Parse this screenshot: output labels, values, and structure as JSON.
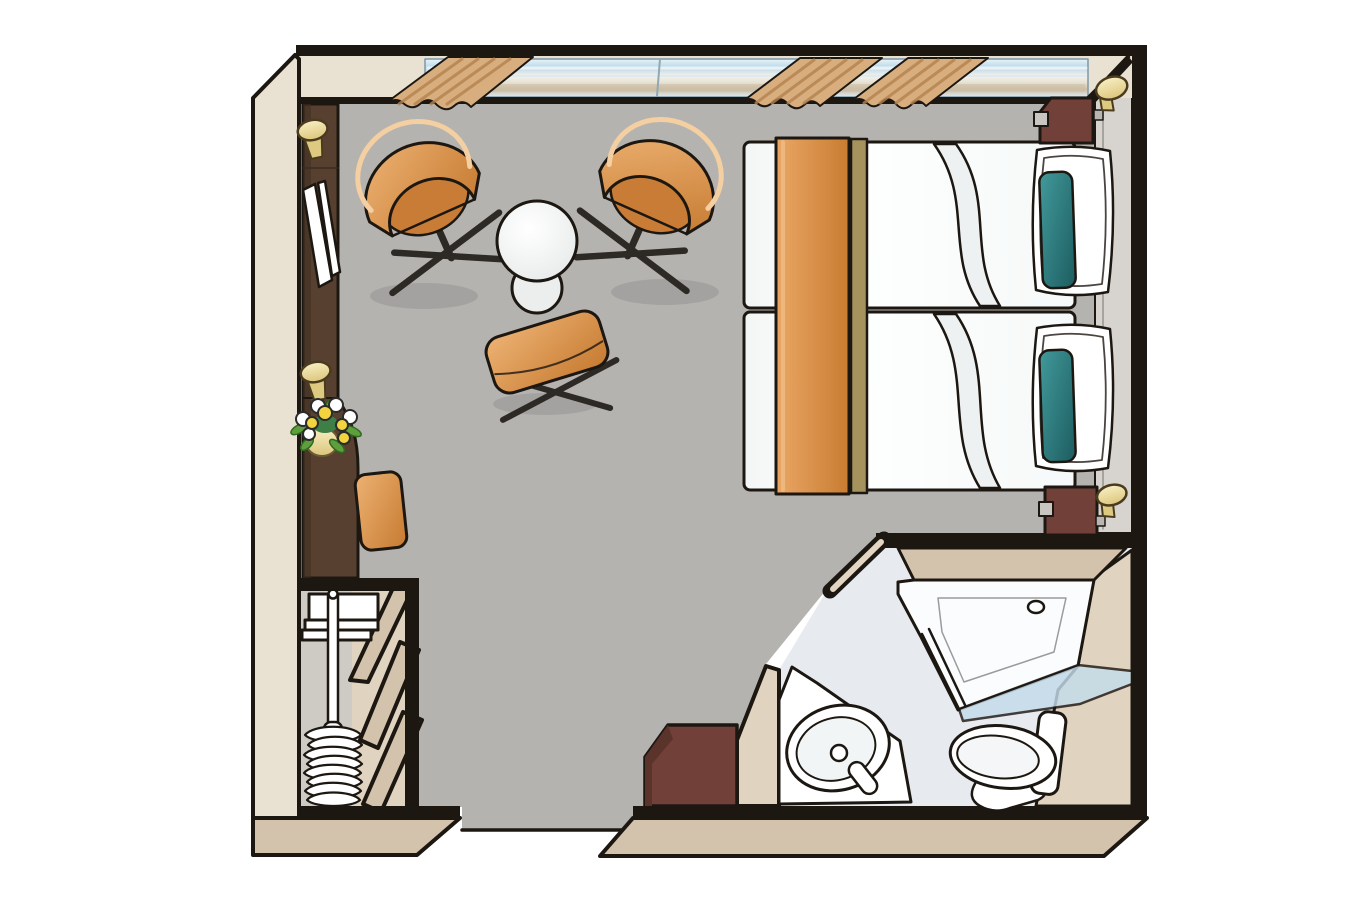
{
  "canvas": {
    "width": 1367,
    "height": 911
  },
  "colors": {
    "paper": "#ffffff",
    "outline": "#1d1712",
    "leg_dark": "#2d2925",
    "wall_beige": "#e9e1d1",
    "wall_beige_mid": "#e0d3c0",
    "wall_beige_dark": "#d4c3ac",
    "floor_gray": "#b5b3b0",
    "gray_strip": "#d7d4d0",
    "closet_bg": "#cecbc5",
    "bath_floor": "#e7eaee",
    "glass_blue": "#c3dcea",
    "wood_dark": "#57402f",
    "wood_red": "#714139",
    "cream": "#f2e7b0",
    "cream_dark": "#ddc97f",
    "runner_olive": "#a5925c",
    "curtain": "#d8ae7f",
    "curtain_dark": "#b5834e",
    "teal": "#2e7f80",
    "leaf": "#5f9e3c",
    "flower_yellow": "#f2d43e",
    "white": "#ffffff",
    "off_white": "#eceeee",
    "shadow_ink": "#000000"
  },
  "plan": {
    "type": "floor-plan",
    "areas": [
      {
        "name": "bedroom-sitting-area"
      },
      {
        "name": "bathroom"
      },
      {
        "name": "wardrobe-closet"
      },
      {
        "name": "entrance"
      }
    ],
    "items": [
      "window-band",
      "curtain-left",
      "curtain-middle",
      "curtain-right",
      "tub-chair-left",
      "tub-chair-right",
      "round-side-table",
      "footstool",
      "twin-bed-upper",
      "twin-bed-lower",
      "bed-runner",
      "pillow-upper",
      "pillow-lower",
      "nightstand-upper",
      "nightstand-lower",
      "table-lamp-upper",
      "table-lamp-lower",
      "vanity-desk",
      "vanity-stool",
      "vanity-mirror",
      "wall-lamp-upper",
      "wall-lamp-lower",
      "flower-vase",
      "wardrobe-rail",
      "clothes-hangers",
      "wardrobe-shelves",
      "wardrobe-shelf-stack",
      "entry-cabinet",
      "washbasin",
      "faucet",
      "toilet",
      "shower",
      "shower-glass",
      "shower-drain"
    ]
  }
}
